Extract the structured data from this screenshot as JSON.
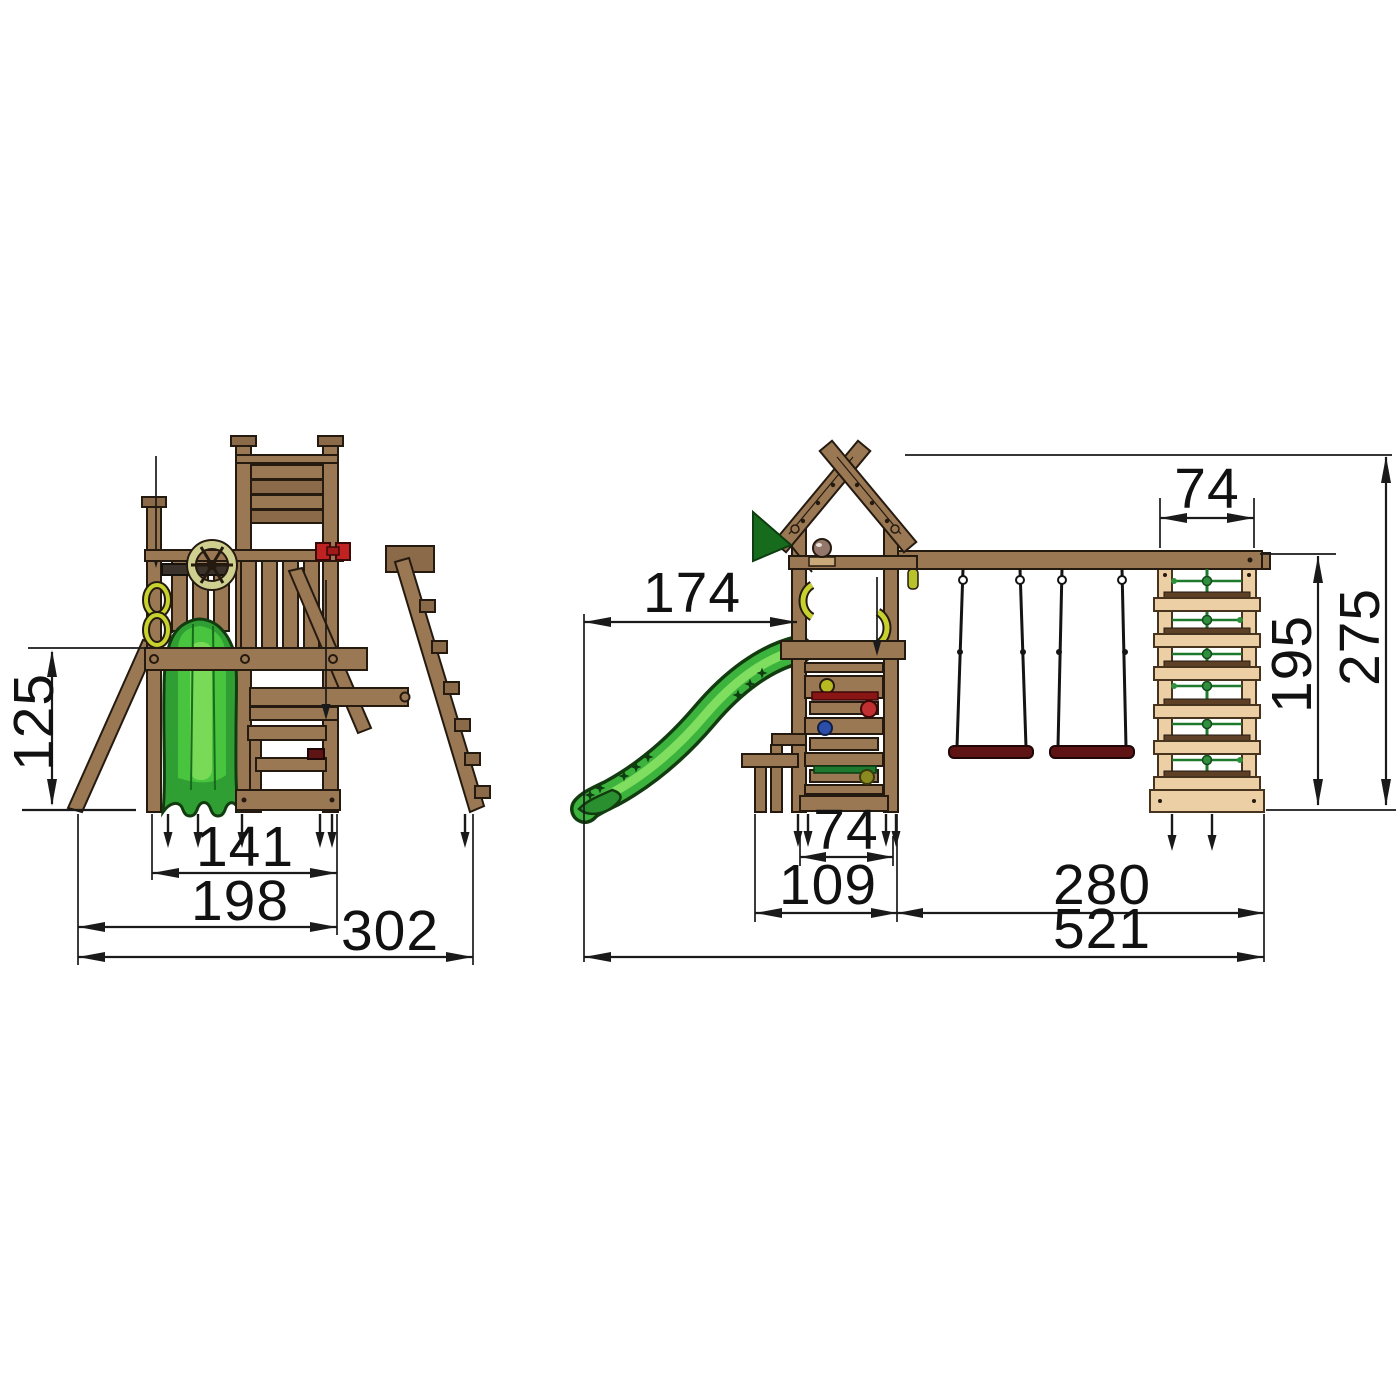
{
  "views": {
    "side_view": {
      "dims": {
        "platform_height": "125",
        "tower_width": "141",
        "base_width": "198",
        "total_depth": "302"
      }
    },
    "front_view": {
      "dims": {
        "slide_reach": "174",
        "climb_frame_width": "74",
        "climb_frame_height": "195",
        "total_height": "275",
        "tower_width": "74",
        "tower_base_depth": "109",
        "swing_section_width": "280",
        "total_width": "521"
      }
    }
  },
  "colors": {
    "wood": "#9b7854",
    "wood_light": "#eccfa5",
    "wood_dark": "#8a6a48",
    "outline": "#241a10",
    "slide_green": "#3cb33c",
    "slide_green_light": "#7fdd5f",
    "slide_green_dark": "#123c10",
    "flag_green": "#176b1d",
    "net_green": "#1d7a2c",
    "swing_seat": "#5e1414",
    "hold_red": "#c03030",
    "hold_bar_red": "#8a1515",
    "hold_blue": "#2b4fa8",
    "hold_yellow": "#b8ba22",
    "hold_olive": "#8a8a20",
    "dimension": "#1a1a1a"
  }
}
